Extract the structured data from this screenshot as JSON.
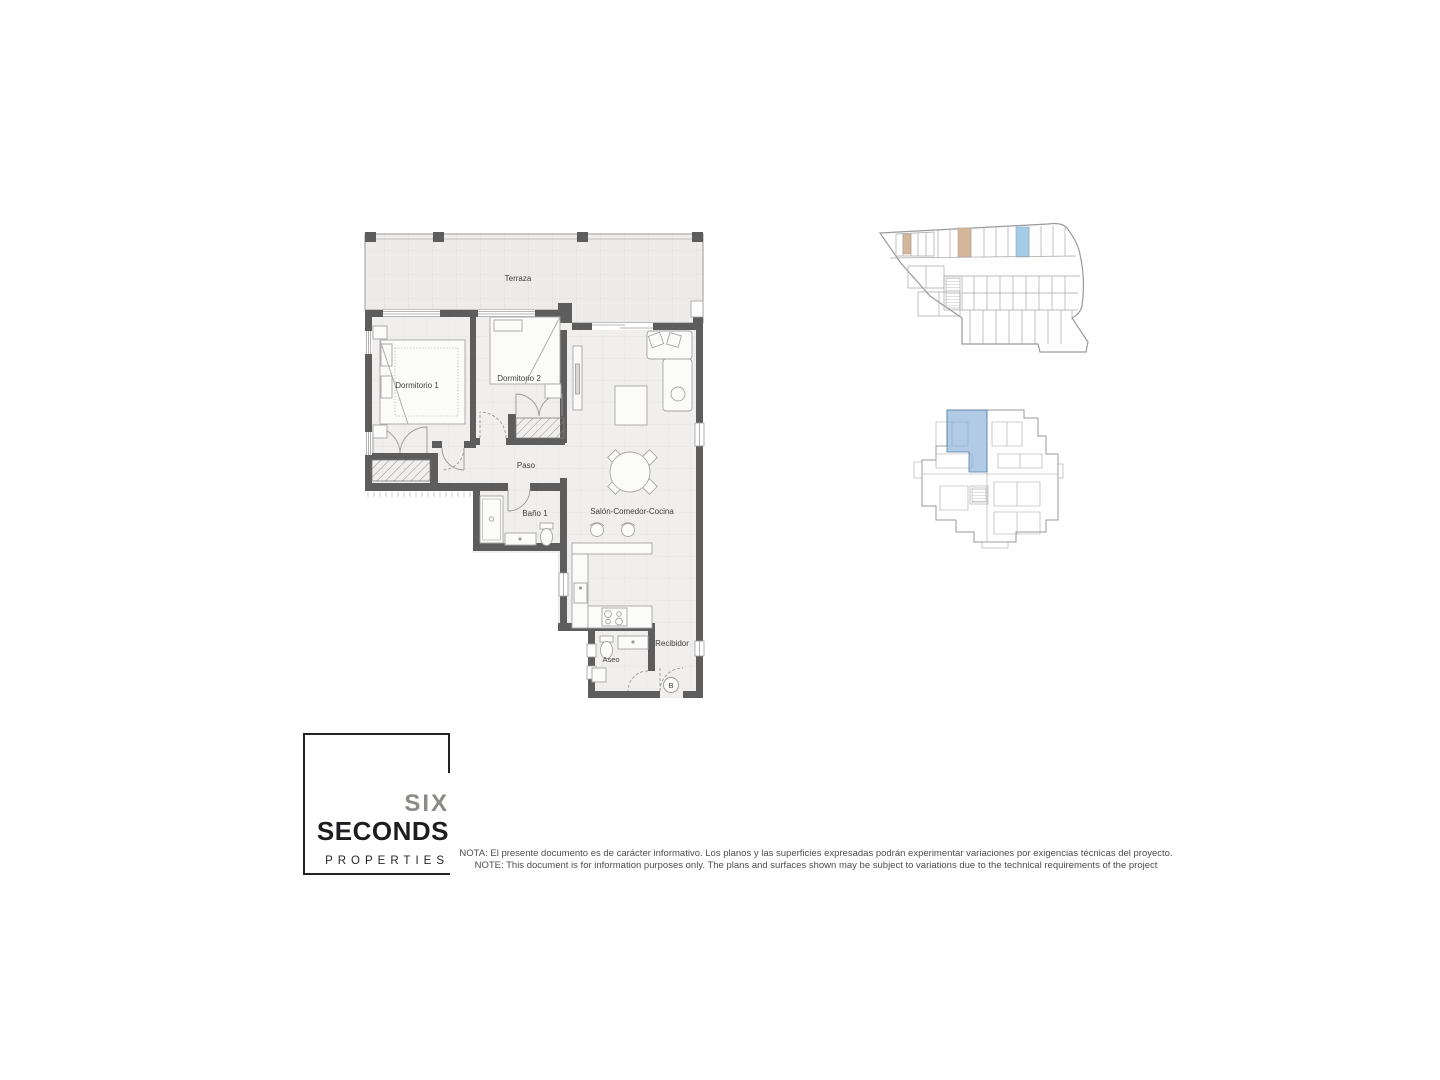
{
  "floor_plan": {
    "rooms": {
      "terraza": "Terraza",
      "dormitorio1": "Dormitorio 1",
      "dormitorio2": "Dormitorio 2",
      "paso": "Paso",
      "bano1": "Baño 1",
      "salon": "Salón-Comedor-Cocina",
      "aseo": "Aseo",
      "recibidor": "Recibidor"
    },
    "entrance_marker": "B",
    "colors": {
      "wall": "#5d5d5e",
      "floor": "#f0efee",
      "terrace_floor": "#edeceb",
      "furniture": "#a6a6a6"
    }
  },
  "key_plans": {
    "garage": {
      "storage_highlight": "#d5b69a",
      "parking_highlight": "#a4cbe7",
      "outline": "#9a9a9a"
    },
    "floor": {
      "unit_highlight": "#7fa9d2",
      "unit_outline": "#4d7fae",
      "outline": "#9a9a9a"
    }
  },
  "logo": {
    "word1": "SIX",
    "word2": "SECONDS",
    "word3": "PROPERTIES"
  },
  "disclaimer": {
    "line_es": "NOTA: El presente documento es de carácter informativo. Los planos y las superficies expresadas podrán experimentar variaciones por exigencias técnicas del proyecto.",
    "line_en": "NOTE: This document is for information purposes only. The plans and surfaces shown may be subject to variations due to the technical requirements of the project"
  }
}
